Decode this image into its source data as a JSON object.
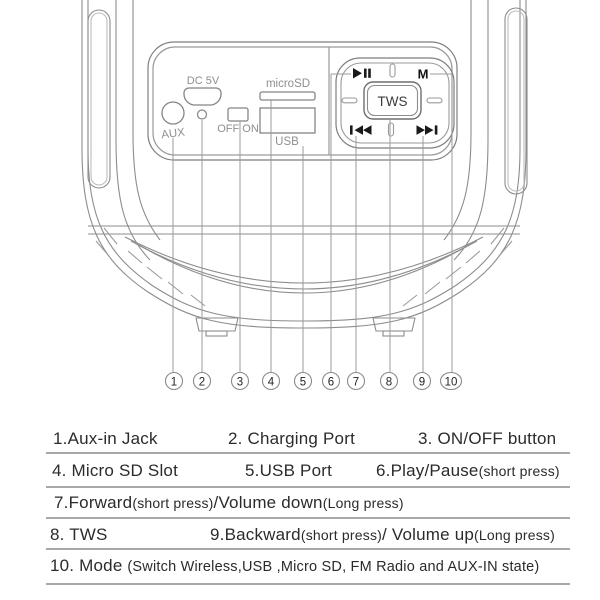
{
  "figure": {
    "panel": {
      "aux_label": "AUX",
      "dc_label": "DC 5V",
      "switch_label": "OFF ON",
      "microsd_label": "microSD",
      "usb_label": "USB",
      "tws_label": "TWS",
      "mode_label": "M"
    },
    "icons": {
      "play_pause": "▶❙❙",
      "previous": "❙◀◀",
      "next": "▶▶❙"
    },
    "callouts": [
      "1",
      "2",
      "3",
      "4",
      "5",
      "6",
      "7",
      "8",
      "9",
      "10"
    ]
  },
  "legend": {
    "r1c1": "1.Aux-in Jack",
    "r1c2": "2. Charging Port",
    "r1c3": "3. ON/OFF button",
    "r2c1": "4. Micro SD Slot",
    "r2c2": "5.USB Port",
    "r2c3a": "6.Play/Pause",
    "r2c3b": "(short press)",
    "r3a": "7.Forward",
    "r3b": "(short press)",
    "r3c": "/Volume down",
    "r3d": "(Long press)",
    "r4c1": "8. TWS",
    "r4c2a": "9.Backward",
    "r4c2b": "(short press)",
    "r4c2c": "/ Volume up",
    "r4c2d": "(Long press)",
    "r5a": "10. Mode ",
    "r5b": "(Switch Wireless,USB ,Micro SD, FM Radio and AUX-IN state)"
  },
  "colors": {
    "line": "#8d8d8d",
    "dark_symbol": "#1a1a1a",
    "label_gray": "#8f8f8f",
    "legend_text": "#2b2b2b",
    "divider": "#a8a8a8"
  }
}
